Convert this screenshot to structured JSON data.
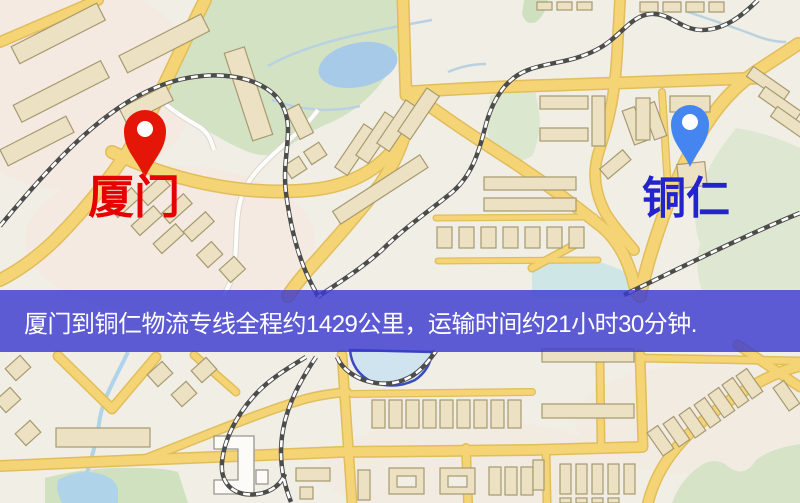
{
  "banner": {
    "text": "厦门到铜仁物流专线全程约1429公里，运输时间约21小时30分钟.",
    "background_color": "#3b3bce",
    "text_color": "#ffffff"
  },
  "markers": {
    "origin": {
      "label": "厦门",
      "pin_color": "#e81505",
      "label_color": "#e60000"
    },
    "destination": {
      "label": "铜仁",
      "pin_color": "#4285f4",
      "label_color": "#2424cc"
    }
  },
  "map": {
    "colors": {
      "background": "#f1eee5",
      "road_fill": "#f6d473",
      "road_casing": "#e2bd58",
      "park_green": "#d3e2c2",
      "water_blue": "#a6cae9",
      "building_tan": "#ece1c1",
      "building_outline": "#a79a70",
      "railway_dark": "#4c4c4a"
    }
  }
}
